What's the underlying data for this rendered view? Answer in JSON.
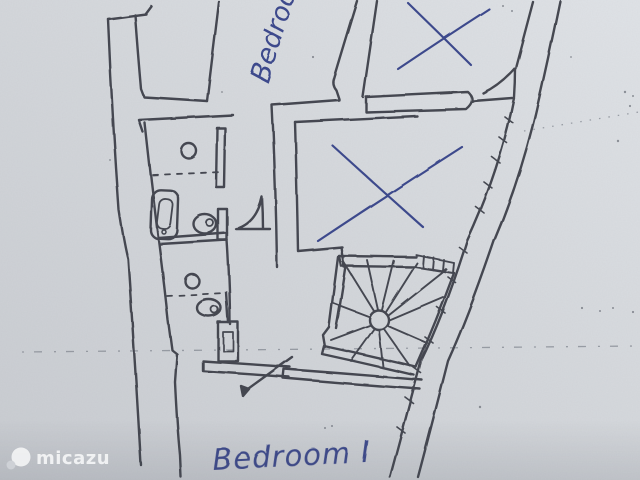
{
  "labels": {
    "room_top": "Bedroom",
    "room_bottom": "Bedroom I"
  },
  "watermark": {
    "text": "micazu",
    "logo": "circle-bubble-icon"
  },
  "annotations": {
    "x_marks": [
      {
        "location": "top-right-room"
      },
      {
        "location": "middle-room"
      }
    ]
  },
  "fixtures": [
    "spiral-staircase",
    "toilet",
    "toilet",
    "sink",
    "sink",
    "bathtub",
    "shower-unit",
    "door-swing",
    "door-swing",
    "door-swing"
  ],
  "colors": {
    "paper": "#d4d7db",
    "pencil": "#3a3e46",
    "ink_blue": "#3d4a8c",
    "watermark": "#ffffff"
  }
}
